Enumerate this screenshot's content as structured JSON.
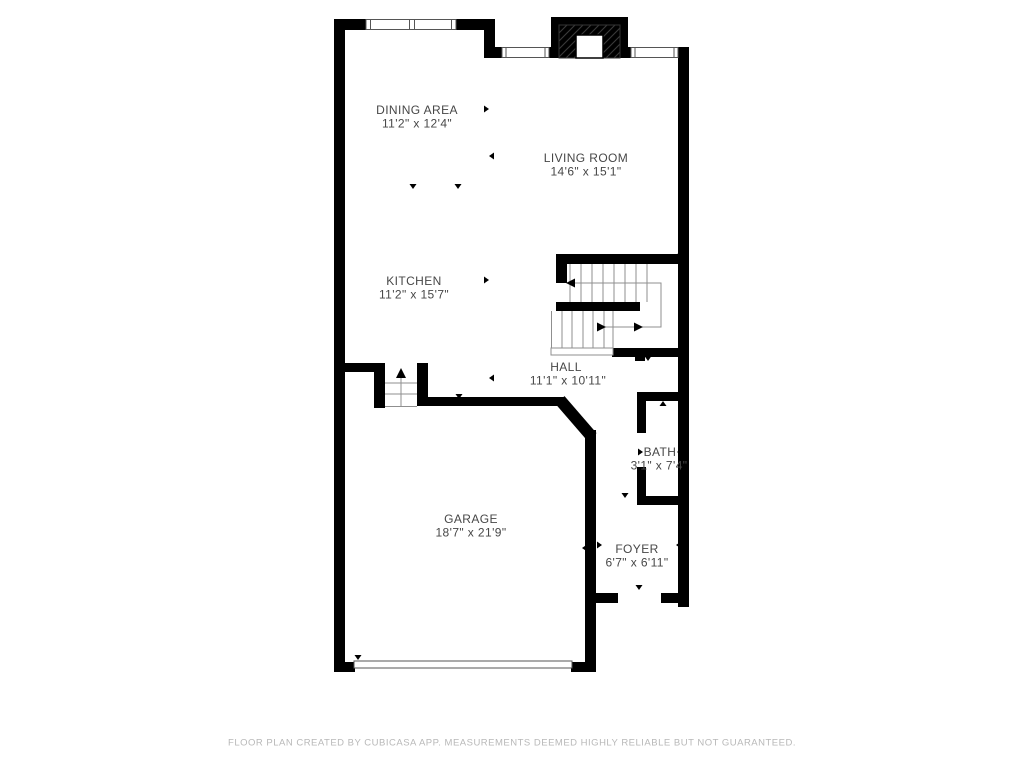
{
  "rooms": {
    "dining_area": {
      "name": "DINING AREA",
      "dims": "11'2\" x 12'4\""
    },
    "living_room": {
      "name": "LIVING ROOM",
      "dims": "14'6\" x 15'1\""
    },
    "kitchen": {
      "name": "KITCHEN",
      "dims": "11'2\" x 15'7\""
    },
    "hall": {
      "name": "HALL",
      "dims": "11'1\" x 10'11\""
    },
    "bath": {
      "name": "BATH",
      "dims": "3'1\" x 7'4\""
    },
    "garage": {
      "name": "GARAGE",
      "dims": "18'7\" x 21'9\""
    },
    "foyer": {
      "name": "FOYER",
      "dims": "6'7\" x 6'11\""
    }
  },
  "footer": {
    "disclaimer": "FLOOR PLAN CREATED BY CUBICASA APP. MEASUREMENTS DEEMED HIGHLY RELIABLE BUT NOT GUARANTEED."
  },
  "colors": {
    "wall": "#000000",
    "text": "#474747",
    "footer_text": "#b8b8b8",
    "line": "#8f8f8f",
    "background": "#ffffff"
  }
}
